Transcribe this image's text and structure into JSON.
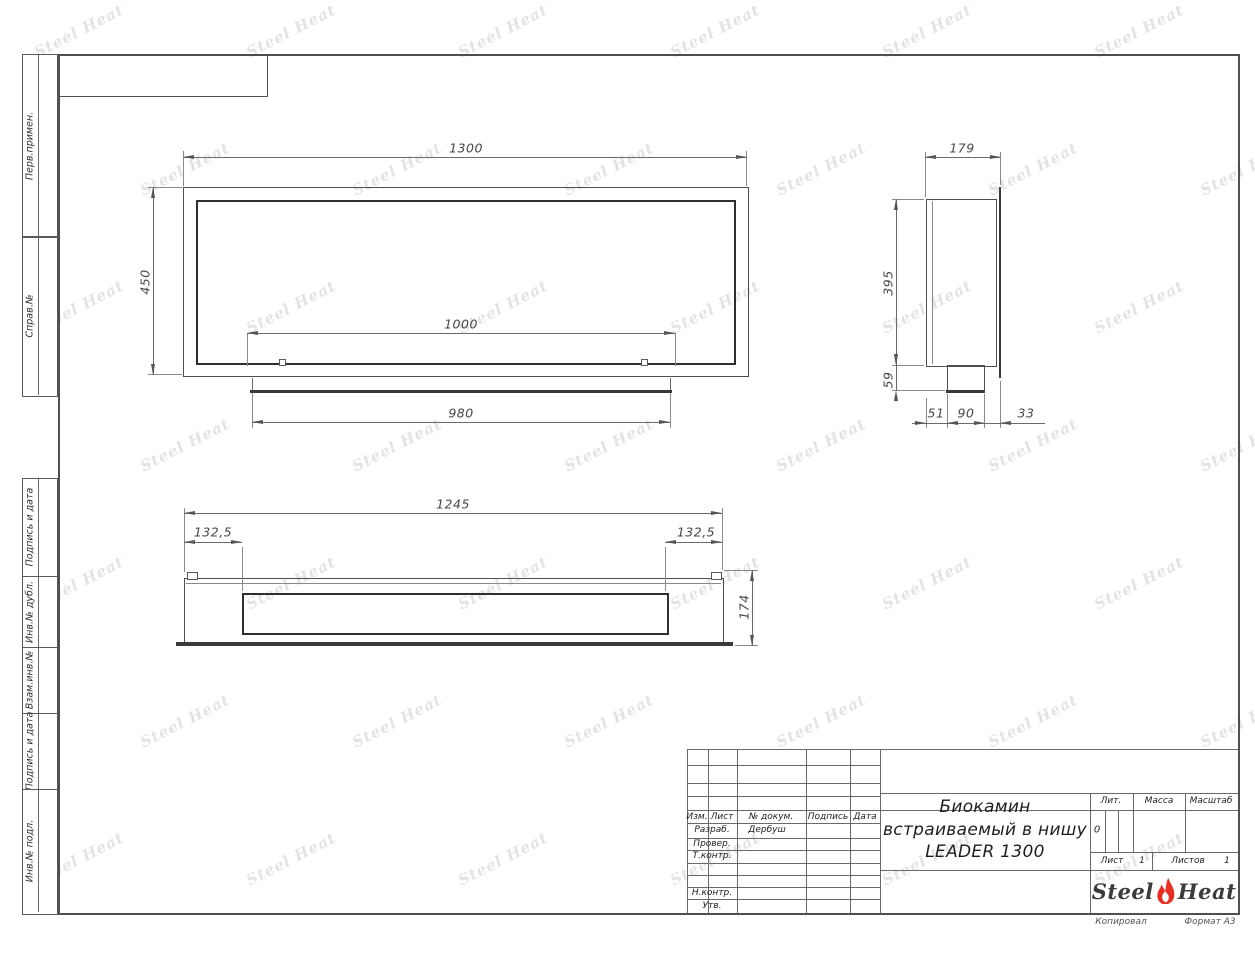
{
  "drawing": {
    "margin_labels": [
      "Перв.примен.",
      "Справ.№",
      "Подпись и дата",
      "Инв.№ дубл.",
      "Взам.инв.№",
      "Подпись и дата",
      "Инв.№ подл."
    ],
    "views": {
      "front": {
        "width": "1300",
        "height": "450",
        "opening_width": "1000",
        "tray_width": "980"
      },
      "side": {
        "depth": "179",
        "body_height": "395",
        "bottom_height": "59",
        "offset_front": "51",
        "burner_depth": "90",
        "offset_back": "33"
      },
      "top": {
        "width": "1245",
        "inset_left": "132,5",
        "inset_right": "132,5",
        "depth": "174"
      }
    },
    "title_block": {
      "rev_header": {
        "izm": "Изм.",
        "list": "Лист",
        "doc": "№ докум.",
        "sign": "Подпись",
        "date": "Дата"
      },
      "staff": [
        {
          "role": "Разраб.",
          "name": "Дербуш"
        },
        {
          "role": "Провер.",
          "name": ""
        },
        {
          "role": "Т.контр.",
          "name": ""
        },
        {
          "role": "Н.контр.",
          "name": ""
        },
        {
          "role": "Утв.",
          "name": ""
        }
      ],
      "title_lines": [
        "Биокамин",
        "встраиваемый в нишу",
        "LEADER 1300"
      ],
      "lit_label": "Лит.",
      "lit_value": "0",
      "mass_label": "Масса",
      "scale_label": "Масштаб",
      "sheet_label": "Лист",
      "sheet_number": "1",
      "sheets_label": "Листов",
      "sheets_total": "1"
    },
    "logo": {
      "steel": "Steel",
      "heat": "Heat",
      "flame_color": "#e63024"
    },
    "footer": {
      "copied": "Копировал",
      "format": "Формат А3"
    },
    "watermark": {
      "text": "Steel Heat"
    }
  }
}
